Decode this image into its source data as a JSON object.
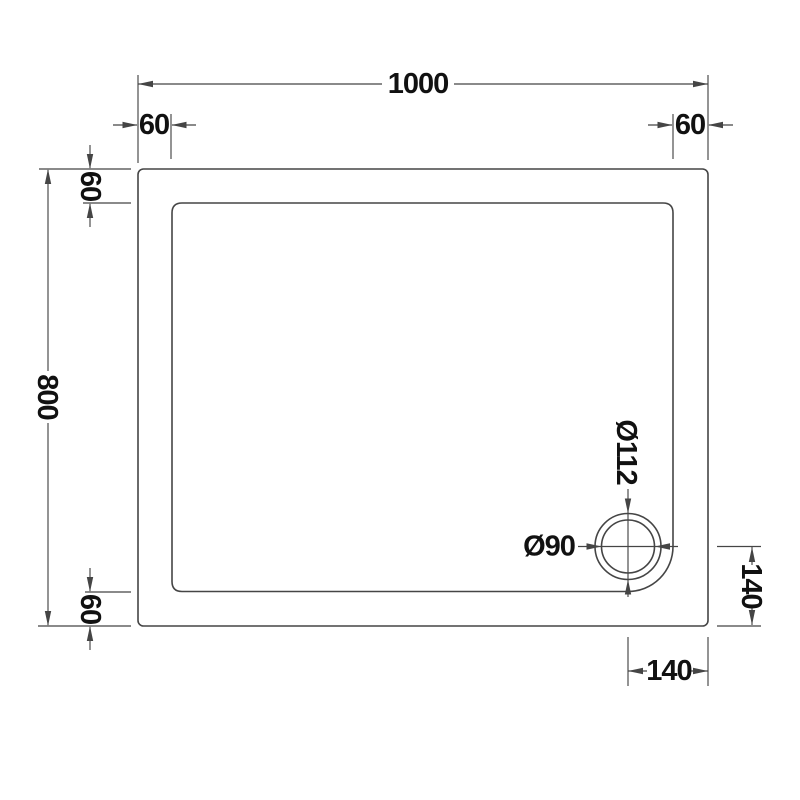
{
  "colors": {
    "background": "#ffffff",
    "line": "#454545",
    "text": "#111111"
  },
  "dimensions": {
    "overall_width": "1000",
    "overall_depth": "800",
    "flange_top_left": "60",
    "flange_top_right": "60",
    "flange_left_top": "60",
    "flange_left_bottom": "60",
    "waste_outer_diameter": "Ø112",
    "waste_inner_diameter": "Ø90",
    "waste_offset_right_side": "140",
    "waste_offset_bottom": "140"
  }
}
